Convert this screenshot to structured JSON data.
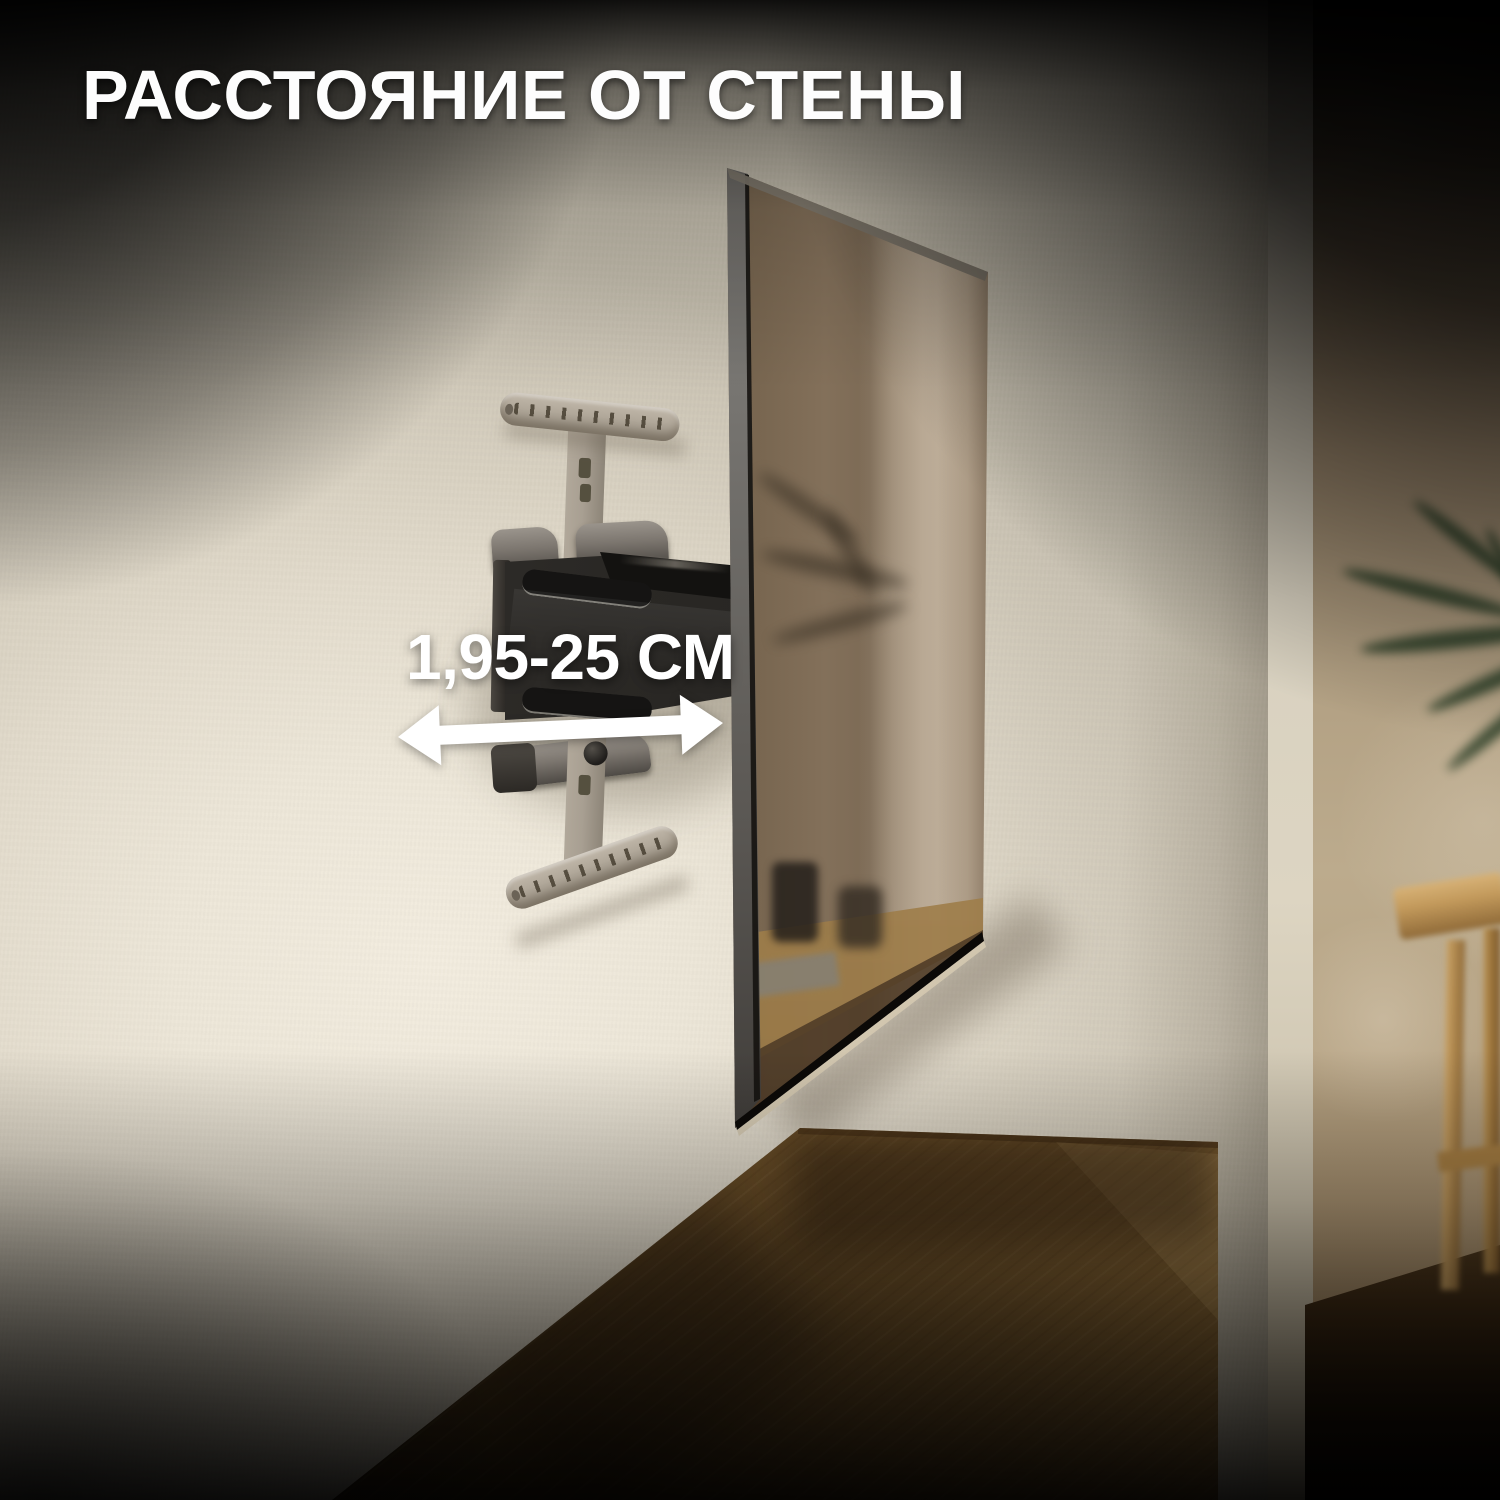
{
  "header": {
    "title": "РАССТОЯНИЕ ОТ СТЕНЫ"
  },
  "annotation": {
    "distance_label": "1,95-25 СМ",
    "arrow_color": "#ffffff"
  },
  "palette": {
    "top_fade": "#000000",
    "wall_light": "#ece6d8",
    "far_wall_tan": "#b2a083",
    "tv_screen_bronze": "#93806a",
    "sideboard_wood": "#b98f52",
    "mount_silver": "#aaa193",
    "mount_black": "#2a2825",
    "text_white": "#ffffff"
  },
  "scene": {
    "objects": [
      "textured-wall",
      "full-motion-tv-wall-mount",
      "tv-side-profile",
      "wood-sideboard",
      "potted-plant-blurred",
      "wood-stool-blurred"
    ]
  }
}
